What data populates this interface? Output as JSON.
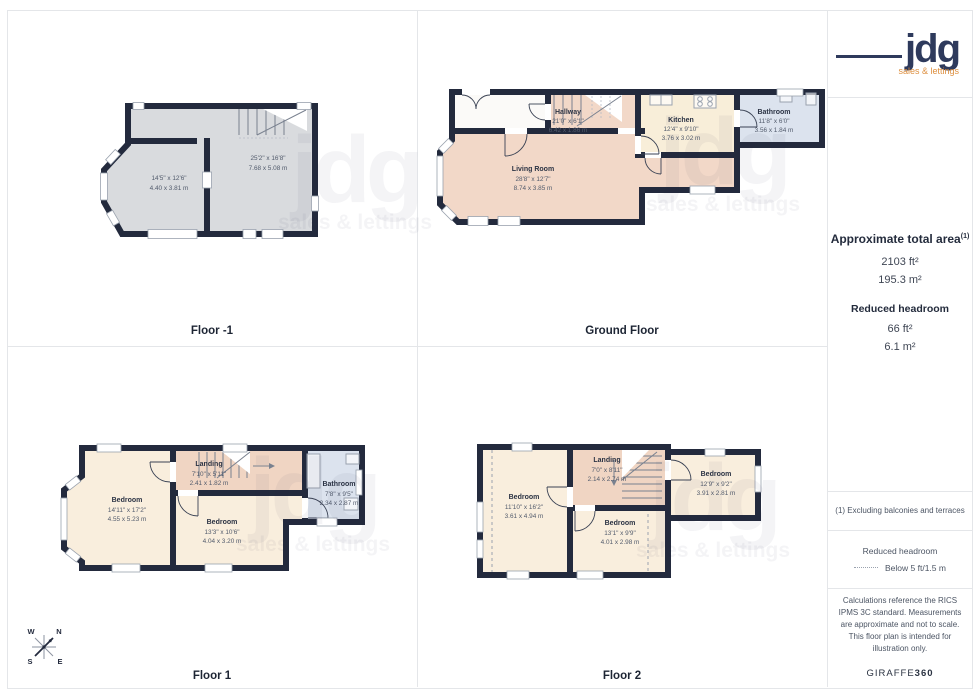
{
  "branding": {
    "logo_text": "jdg",
    "logo_tagline": "sales & lettings"
  },
  "watermark": {
    "line1": "jdg",
    "line2": "sales & lettings"
  },
  "sidebar": {
    "total_area": {
      "title": "Approximate total area",
      "footnote_marker": "(1)",
      "imperial": "2103 ft²",
      "metric": "195.3 m²"
    },
    "reduced_headroom_summary": {
      "title": "Reduced headroom",
      "imperial": "66 ft²",
      "metric": "6.1 m²"
    },
    "footnote": "(1) Excluding balconies and terraces",
    "legend": {
      "title": "Reduced headroom",
      "label": "Below 5 ft/1.5 m"
    },
    "disclaimer": "Calculations reference the RICS IPMS 3C standard. Measurements are approximate and not to scale. This floor plan is intended for illustration only.",
    "provider": {
      "name": "GIRAFFE",
      "suffix": "360"
    }
  },
  "compass": {
    "nw": "W",
    "ne": "N",
    "sw": "S",
    "se": "E"
  },
  "floors": [
    {
      "title": "Floor -1",
      "rooms": [
        {
          "name": "",
          "imperial": "14'5\" x 12'6\"",
          "metric": "4.40 x 3.81 m"
        },
        {
          "name": "",
          "imperial": "25'2\" x 16'8\"",
          "metric": "7.68 x 5.08 m"
        }
      ]
    },
    {
      "title": "Ground Floor",
      "rooms": [
        {
          "name": "Hallway",
          "imperial": "21'0\" x 6'1\"",
          "metric": "6.42 x 1.86 m"
        },
        {
          "name": "Living Room",
          "imperial": "28'8\" x 12'7\"",
          "metric": "8.74 x 3.85 m"
        },
        {
          "name": "Kitchen",
          "imperial": "12'4\" x 9'10\"",
          "metric": "3.76 x 3.02 m"
        },
        {
          "name": "Bathroom",
          "imperial": "11'8\" x 6'0\"",
          "metric": "3.56 x 1.84 m"
        }
      ]
    },
    {
      "title": "Floor 1",
      "rooms": [
        {
          "name": "Bedroom",
          "imperial": "14'11\" x 17'2\"",
          "metric": "4.55 x 5.23 m"
        },
        {
          "name": "Landing",
          "imperial": "7'10\" x 5'11\"",
          "metric": "2.41 x 1.82 m"
        },
        {
          "name": "Bedroom",
          "imperial": "13'3\" x 10'6\"",
          "metric": "4.04 x 3.20 m"
        },
        {
          "name": "Bathroom",
          "imperial": "7'8\" x 9'5\"",
          "metric": "2.34 x 2.87 m"
        }
      ]
    },
    {
      "title": "Floor 2",
      "rooms": [
        {
          "name": "Bedroom",
          "imperial": "11'10\" x 16'2\"",
          "metric": "3.61 x 4.94 m"
        },
        {
          "name": "Landing",
          "imperial": "7'0\" x 8'11\"",
          "metric": "2.14 x 2.74 m"
        },
        {
          "name": "Bedroom",
          "imperial": "13'1\" x 9'9\"",
          "metric": "4.01 x 2.98 m"
        },
        {
          "name": "Bedroom",
          "imperial": "12'9\" x 9'2\"",
          "metric": "3.91 x 2.81 m"
        }
      ]
    }
  ],
  "colors": {
    "wall": "#232a3d",
    "room_gray": "#d9dbde",
    "room_peach": "#f2d8c8",
    "room_cream": "#f9eedd",
    "landing_peach": "#f0d5c3",
    "room_blue": "#dce3ee",
    "logo_navy": "#2e3a5c",
    "logo_orange": "#dd8f3f",
    "grid_border": "#e4e6e9"
  }
}
